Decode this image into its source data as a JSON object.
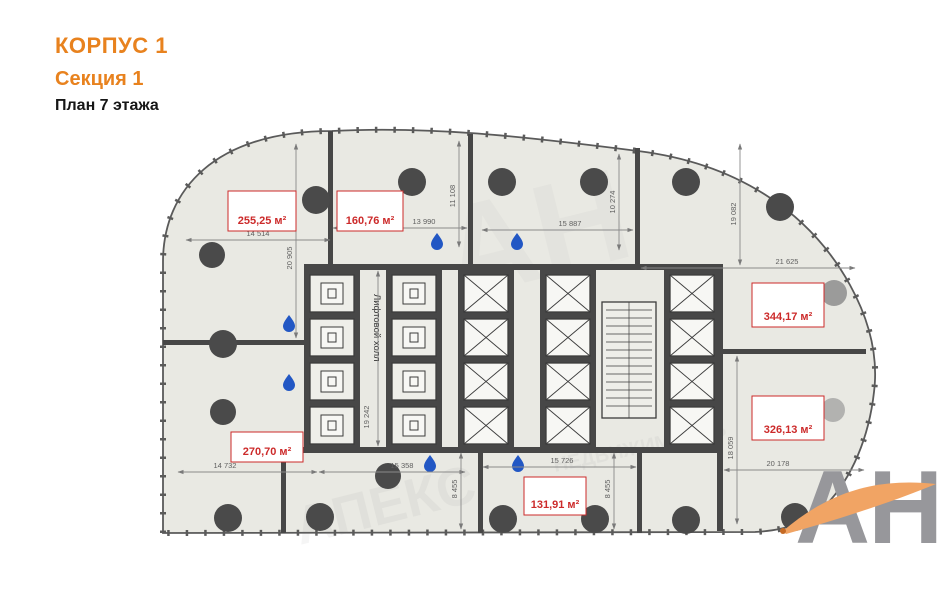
{
  "header": {
    "building": "КОРПУС 1",
    "section": "Секция 1",
    "plan": "План 7 этажа",
    "accent_color": "#e8821e"
  },
  "plan": {
    "floor_fill": "#e9e9e3",
    "wall_color": "#474747",
    "area_label_color": "#cc2a2a",
    "dim_color": "#5f5f5f",
    "drop_color": "#2257c4",
    "column_color": "#4a4a4a",
    "lobby_label": "Лифтовой холл",
    "rooms": [
      {
        "area": "255,25 м²"
      },
      {
        "area": "160,76 м²"
      },
      {
        "area": "344,17 м²"
      },
      {
        "area": "326,13 м²"
      },
      {
        "area": "270,70 м²"
      },
      {
        "area": "131,91 м²"
      }
    ],
    "dimensions": [
      {
        "value": "14 514"
      },
      {
        "value": "13 990"
      },
      {
        "value": "15 887"
      },
      {
        "value": "21 625"
      },
      {
        "value": "14 732"
      },
      {
        "value": "15 358"
      },
      {
        "value": "15 726"
      },
      {
        "value": "20 178"
      },
      {
        "value": "20 905"
      },
      {
        "value": "11 108"
      },
      {
        "value": "10 274"
      },
      {
        "value": "19 082"
      },
      {
        "value": "19 242"
      },
      {
        "value": "8 455"
      },
      {
        "value": "8 455"
      },
      {
        "value": "18 059"
      }
    ]
  },
  "watermark": {
    "monogram": "АН",
    "line1": "АПЕКС",
    "line2": "НЕДВИЖИМОСТЬ"
  },
  "logo": {
    "text": "АН",
    "text_color": "#97979b",
    "swoosh_color": "#f1a464"
  }
}
